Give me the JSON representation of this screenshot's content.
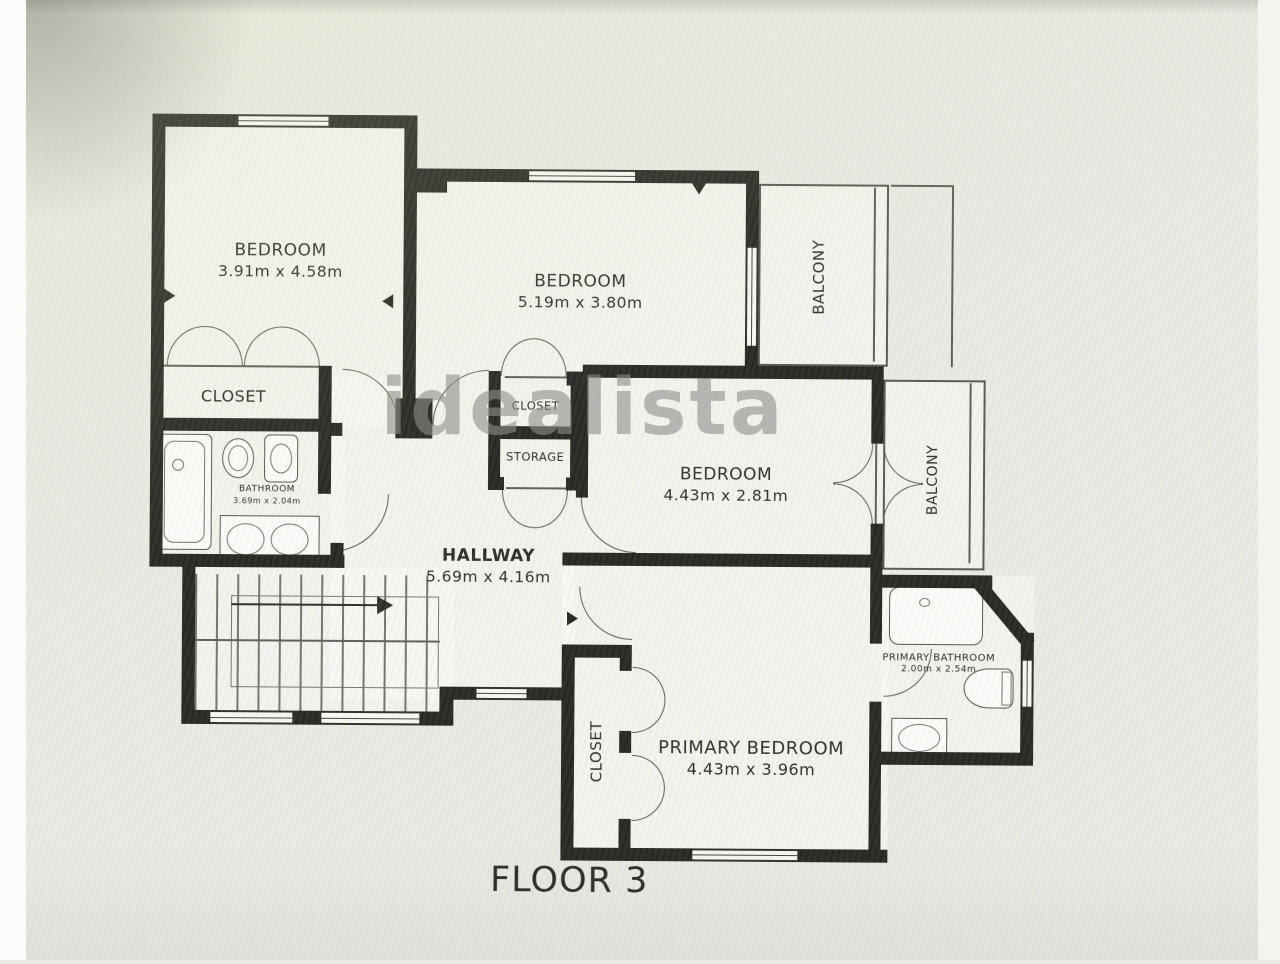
{
  "floor": {
    "title": "FLOOR 3"
  },
  "watermark": {
    "text": "idealista"
  },
  "rooms": {
    "bedroom1": {
      "name": "BEDROOM",
      "dims": "3.91m x 4.58m"
    },
    "bedroom2": {
      "name": "BEDROOM",
      "dims": "5.19m x 3.80m"
    },
    "bedroom3": {
      "name": "BEDROOM",
      "dims": "4.43m x 2.81m"
    },
    "primary_bedroom": {
      "name": "PRIMARY BEDROOM",
      "dims": "4.43m x 3.96m"
    },
    "hallway": {
      "name": "HALLWAY",
      "dims": "5.69m x 4.16m"
    },
    "bathroom": {
      "name": "BATHROOM",
      "dims": "3.69m x 2.04m"
    },
    "primary_bathroom": {
      "name": "PRIMARY BATHROOM",
      "dims": "2.00m x 2.54m"
    },
    "closet1": {
      "name": "CLOSET"
    },
    "closet_hall": {
      "name": "CLOSET"
    },
    "storage": {
      "name": "STORAGE"
    },
    "closet_primary": {
      "name": "CLOSET"
    },
    "balcony_top": {
      "name": "BALCONY"
    },
    "balcony_right": {
      "name": "BALCONY"
    }
  }
}
